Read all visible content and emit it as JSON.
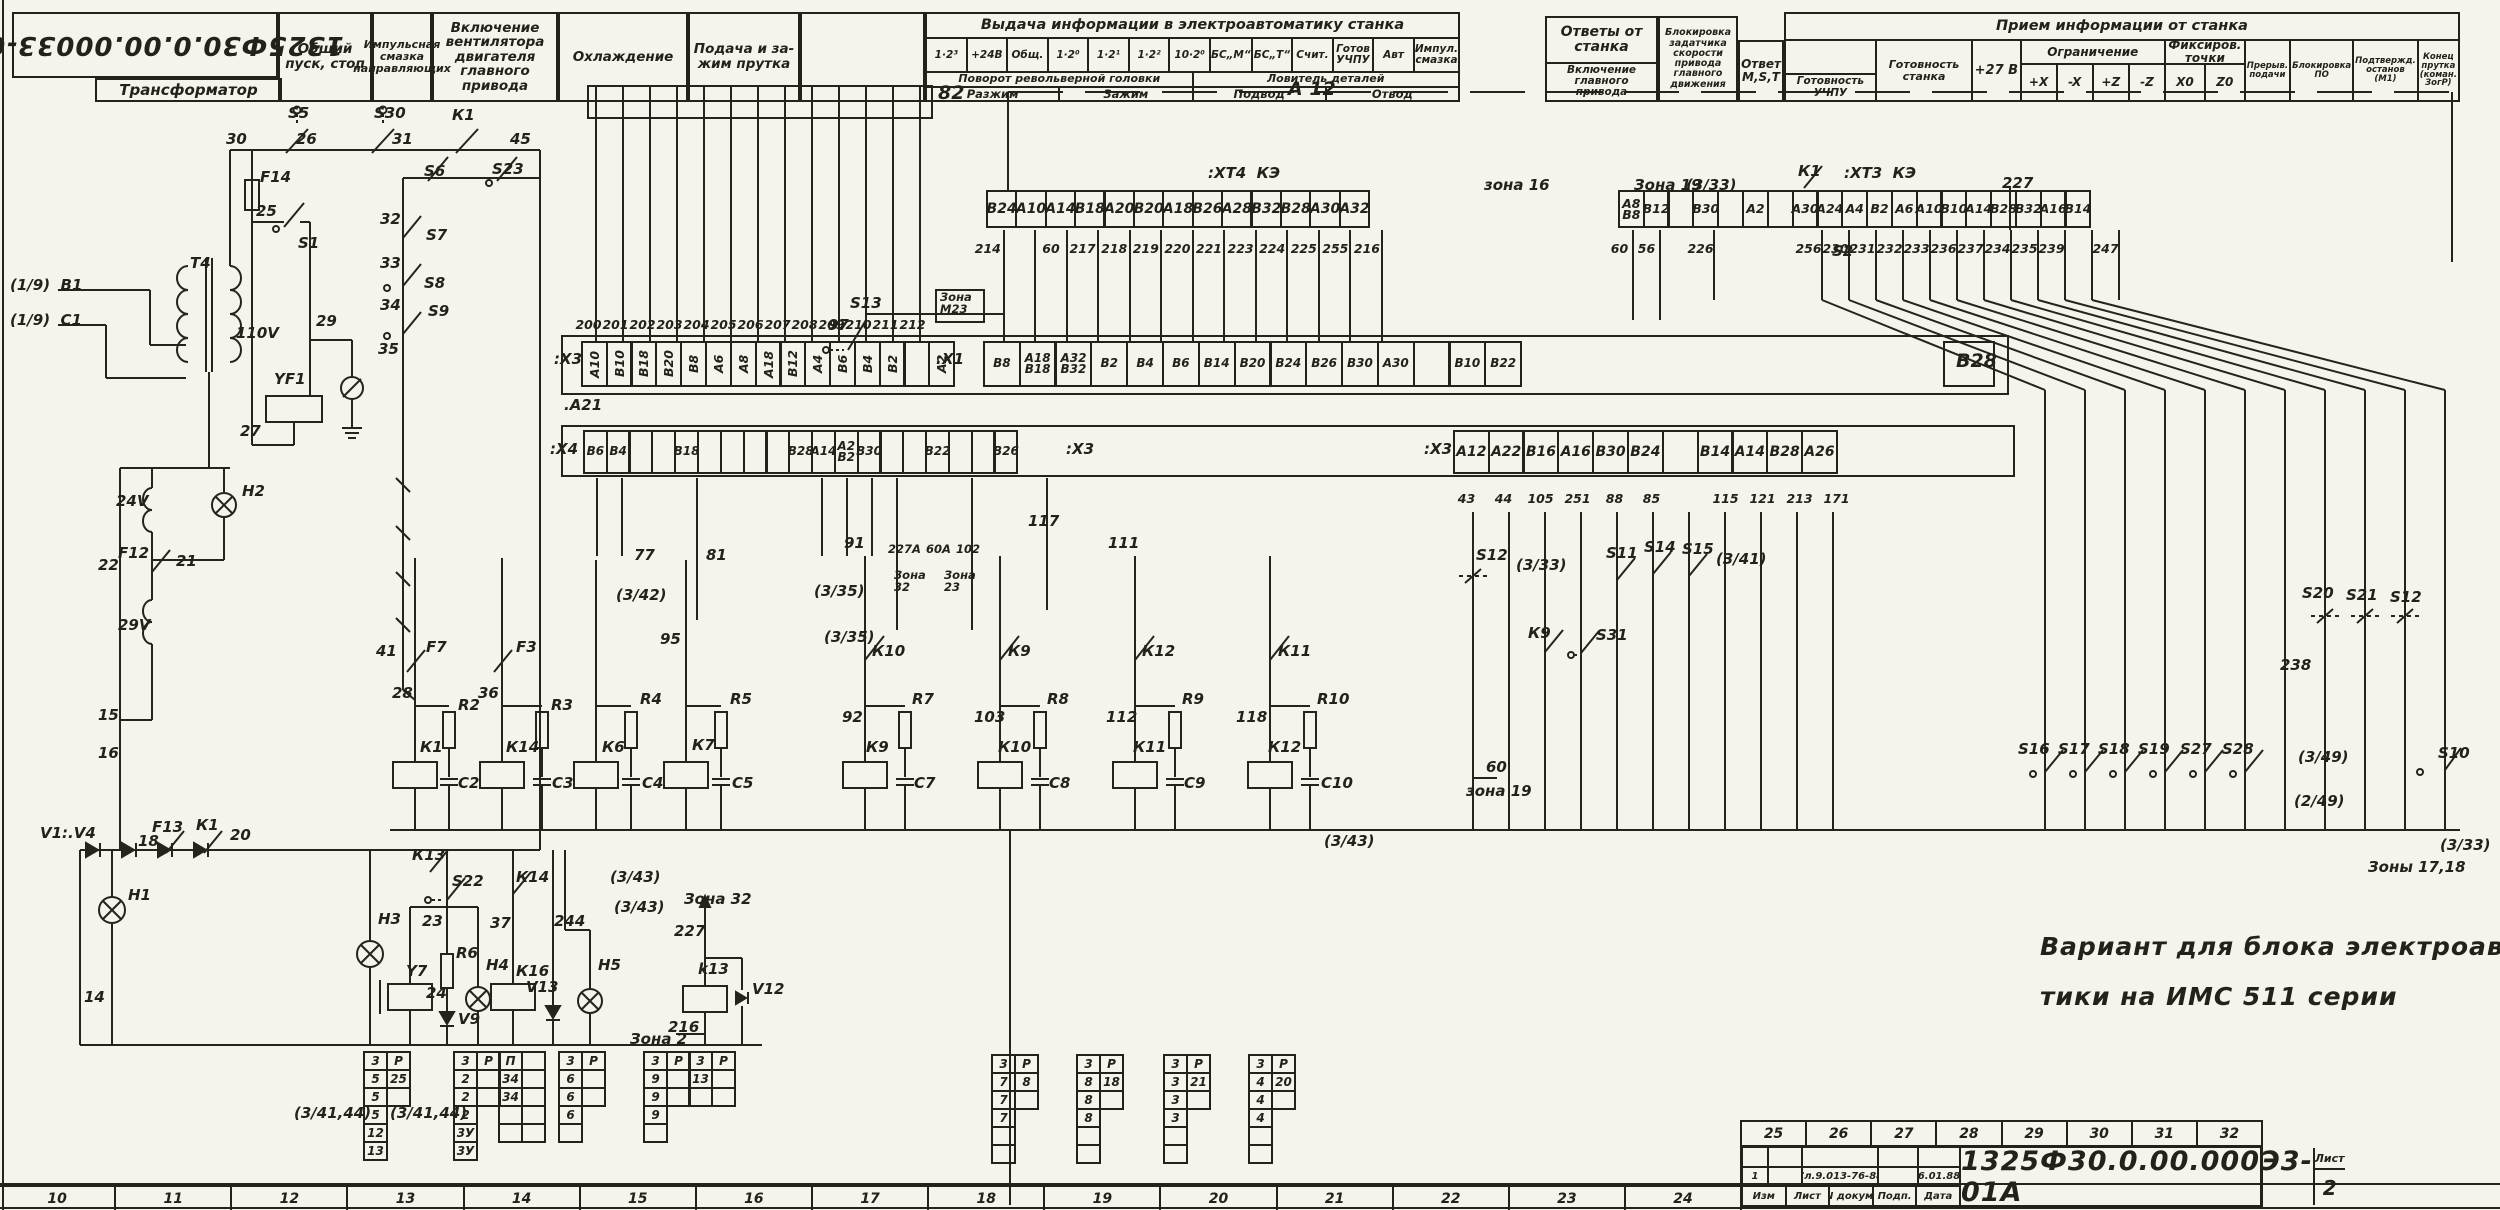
{
  "header": {
    "doc_number_mirrored": "1325Ф30.0.00.00033-01А",
    "transformer_label": "Трансформатор",
    "columns": [
      "Общий пуск, стоп",
      "Импульс­ная смазка направляющих",
      "Включение вентилятора двигателя главного привода",
      "Охлажде­ние",
      "Подача и за­жим прутка",
      ""
    ],
    "output_section": {
      "title": "Выдача информации в электроавтоматику станка",
      "signals": [
        "1·2³",
        "+24В",
        "Общ.",
        "1·2⁰",
        "1·2¹",
        "1·2²",
        "10·2⁰",
        "БС„М“",
        "БС„Т“",
        "Счит.",
        "Готов УЧПУ",
        "Авт",
        "Импул. смазка"
      ],
      "turret_title": "Поворот револьверной головки",
      "turret_cells": [
        "Разжим",
        "Зажим"
      ],
      "catcher_title": "Ловитель деталей",
      "catcher_cells": [
        "Подвод",
        "Отвод"
      ]
    },
    "answers_box": {
      "title": "Ответы от станка",
      "sub": "Включение главного привода"
    },
    "blocking_box": "Блокировка задатчика скорости привода главного движения",
    "answer_mst": "Ответ M,S,T",
    "input_section": {
      "title": "Прием информации от станка",
      "ready_cnc": "Готовность УЧПУ",
      "ready_machine": "Готовность станка",
      "plus27": "+27 В",
      "limit_title": "Ограничение",
      "limit_cells": [
        "+X",
        "-X",
        "+Z",
        "-Z"
      ],
      "fix_title": "Фиксиров. точки",
      "fix_cells": [
        "X0",
        "Z0"
      ],
      "tail_cells": [
        "Прерыв. подачи",
        "Блокировка ПО",
        "Подтвержд. останов (М1)",
        "Конец прутка (коман. ЗогР)"
      ]
    }
  },
  "strips": {
    "xt4": {
      "cells": [
        "В24",
        "А10",
        "А14",
        "В18",
        "А20",
        "В20",
        "А18",
        "В26",
        "А28",
        "В32",
        "В28",
        "А30",
        "А32"
      ],
      "wires": [
        "214",
        "",
        "60",
        "217",
        "218",
        "219",
        "220",
        "221",
        "223",
        "224",
        "225",
        "255",
        "216"
      ]
    },
    "xt3": {
      "cells": [
        "А8\nВ8",
        "В12",
        "",
        "В30",
        "",
        "А2",
        "",
        "А30",
        "А24",
        "А4",
        "В2",
        "А6",
        "А10",
        "В10",
        "А14",
        "В28",
        "В32",
        "А16",
        "В14"
      ],
      "wires": [
        "60",
        "56",
        "",
        "226",
        "",
        "",
        "",
        "256",
        "230",
        "231",
        "232",
        "233",
        "236",
        "237",
        "234",
        "235",
        "239",
        "",
        "247"
      ]
    },
    "x3l": {
      "cells": [
        "А10",
        "В10",
        "В18",
        "В20",
        "В8",
        "А6",
        "А8",
        "А18",
        "В12",
        "А4",
        "В6",
        "В4",
        "В2",
        "",
        "А2"
      ],
      "wires": [
        "200",
        "201",
        "202",
        "203",
        "204",
        "205",
        "206",
        "207",
        "208",
        "209",
        "210",
        "211",
        "212",
        "",
        ""
      ]
    },
    "x1": {
      "cells": [
        "В8",
        "А18\nВ18",
        "А32\nВ32",
        "В2",
        "В4",
        "В6",
        "В14",
        "В20",
        "В24",
        "В26",
        "В30",
        "А30",
        "",
        "В10",
        "В22"
      ],
      "extra": "В28"
    },
    "x4": {
      "cells": [
        "В6",
        "В4",
        "",
        "",
        "В18",
        "",
        "",
        "",
        "",
        "В28",
        "А14",
        "А2\nВ2",
        "В30",
        "",
        "",
        "В22",
        "",
        "",
        "В26"
      ]
    },
    "x3r": {
      "cells": [
        "А12",
        "А22",
        "В16",
        "А16",
        "В30",
        "В24",
        "",
        "В14",
        "А14",
        "В28",
        "А26"
      ],
      "wires": [
        "43",
        "44",
        "105",
        "251",
        "88",
        "85",
        "",
        "115",
        "121",
        "213",
        "171"
      ]
    }
  },
  "note": {
    "line1": "Вариант для блока электроавтома-",
    "line2": "тики на ИМС 511 серии"
  },
  "zones_bottom": [
    "10",
    "11",
    "12",
    "13",
    "14",
    "15",
    "16",
    "17",
    "18",
    "19",
    "20",
    "21",
    "22",
    "23",
    "24"
  ],
  "title_block": {
    "zones": [
      "25",
      "26",
      "27",
      "28",
      "29",
      "30",
      "31",
      "32"
    ],
    "doc_number": "1325Ф30.0.00.000Э3-01А",
    "sheet_label": "Лист",
    "sheet_number": "2",
    "rev_row": {
      "num": "1",
      "doc": "Сл.9.013-76-88",
      "sign": "",
      "date": "6.01.88"
    },
    "footer_cols": [
      "Изм",
      "Лист",
      "N докум.",
      "Подп.",
      "Дата"
    ]
  },
  "labels": [
    [
      "(1/9)  В1",
      10,
      278
    ],
    [
      "(1/9)  С1",
      10,
      313
    ],
    [
      "Т4",
      190,
      256
    ],
    [
      "110V",
      236,
      326
    ],
    [
      "30",
      226,
      132
    ],
    [
      "S5",
      288,
      106
    ],
    [
      "26",
      296,
      132
    ],
    [
      "S30",
      374,
      106
    ],
    [
      "31",
      392,
      132
    ],
    [
      "К1",
      452,
      108
    ],
    [
      "45",
      510,
      132
    ],
    [
      "F14",
      260,
      170
    ],
    [
      "25",
      256,
      204
    ],
    [
      "S1",
      298,
      236
    ],
    [
      "S6",
      424,
      164
    ],
    [
      "S23",
      492,
      162
    ],
    [
      "32",
      380,
      212
    ],
    [
      "S7",
      426,
      228
    ],
    [
      "33",
      380,
      256
    ],
    [
      "S8",
      424,
      276
    ],
    [
      "34",
      380,
      298
    ],
    [
      "S9",
      428,
      304
    ],
    [
      "35",
      378,
      342
    ],
    [
      "29",
      316,
      314
    ],
    [
      "YF1",
      274,
      372
    ],
    [
      "27",
      240,
      424
    ],
    [
      "24V",
      116,
      494
    ],
    [
      "Н2",
      242,
      484
    ],
    [
      "F12",
      118,
      546
    ],
    [
      "22",
      98,
      558
    ],
    [
      "21",
      176,
      554
    ],
    [
      "29V",
      118,
      618
    ],
    [
      "15",
      98,
      708
    ],
    [
      "16",
      98,
      746
    ],
    [
      "V1:.V4",
      40,
      826
    ],
    [
      "F13",
      152,
      820
    ],
    [
      "К1",
      196,
      818
    ],
    [
      "20",
      230,
      828
    ],
    [
      "18",
      138,
      834
    ],
    [
      "Н1",
      128,
      888
    ],
    [
      "14",
      84,
      990
    ],
    [
      "28",
      392,
      686
    ],
    [
      "41",
      376,
      644
    ],
    [
      "F7",
      426,
      640
    ],
    [
      "К1",
      420,
      740
    ],
    [
      "R2",
      458,
      698
    ],
    [
      "С2",
      458,
      776
    ],
    [
      "36",
      478,
      686
    ],
    [
      "F3",
      516,
      640
    ],
    [
      "К14",
      506,
      740
    ],
    [
      "R3",
      551,
      698
    ],
    [
      "С3",
      552,
      776
    ],
    [
      "К6",
      602,
      740
    ],
    [
      "R4",
      640,
      692
    ],
    [
      "С4",
      642,
      776
    ],
    [
      "95",
      660,
      632
    ],
    [
      "К7",
      692,
      738
    ],
    [
      "R5",
      730,
      692
    ],
    [
      "С5",
      732,
      776
    ],
    [
      "77",
      634,
      548
    ],
    [
      "81",
      706,
      548
    ],
    [
      "(3/42)",
      616,
      588
    ],
    [
      "(3/35)",
      814,
      584
    ],
    [
      "(3/35)",
      824,
      630
    ],
    [
      "82",
      938,
      84,
      "b"
    ],
    [
      ".А21",
      564,
      398
    ],
    [
      "А 12",
      1288,
      80,
      "b"
    ],
    [
      ":ХТ4  КЭ",
      1208,
      166
    ],
    [
      "S13",
      850,
      296
    ],
    [
      "97",
      828,
      318
    ],
    [
      "Зона\nМ23",
      940,
      292,
      "s"
    ],
    [
      "зона 16",
      1484,
      178
    ],
    [
      "Зона 19",
      1634,
      178
    ],
    [
      "(3/33)",
      1686,
      178
    ],
    [
      "К1",
      1798,
      164
    ],
    [
      "227",
      2002,
      176
    ],
    [
      "S2",
      1832,
      244
    ],
    [
      ":ХТ3  КЭ",
      1844,
      166
    ],
    [
      "91",
      844,
      536
    ],
    [
      "227А",
      888,
      544,
      "s"
    ],
    [
      "60А",
      926,
      544,
      "s"
    ],
    [
      "102",
      956,
      544,
      "s"
    ],
    [
      "Зона\n32",
      894,
      570,
      "s"
    ],
    [
      "Зона\n23",
      944,
      570,
      "s"
    ],
    [
      "К10",
      872,
      644
    ],
    [
      "92",
      842,
      710
    ],
    [
      "К9",
      866,
      740
    ],
    [
      "R7",
      912,
      692
    ],
    [
      "С7",
      914,
      776
    ],
    [
      "103",
      974,
      710
    ],
    [
      "К9",
      1008,
      644
    ],
    [
      "К10",
      998,
      740
    ],
    [
      "R8",
      1047,
      692
    ],
    [
      "С8",
      1049,
      776
    ],
    [
      "111",
      1108,
      536
    ],
    [
      "112",
      1106,
      710
    ],
    [
      "К12",
      1142,
      644
    ],
    [
      "К11",
      1133,
      740
    ],
    [
      "R9",
      1182,
      692
    ],
    [
      "С9",
      1184,
      776
    ],
    [
      "118",
      1236,
      710
    ],
    [
      "К11",
      1278,
      644
    ],
    [
      "К12",
      1268,
      740
    ],
    [
      "R10",
      1317,
      692
    ],
    [
      "С10",
      1321,
      776
    ],
    [
      "117",
      1028,
      514
    ],
    [
      "(3/43)",
      1324,
      834
    ],
    [
      "S12",
      1476,
      548
    ],
    [
      "(3/33)",
      1516,
      558
    ],
    [
      "К9",
      1528,
      626
    ],
    [
      "S31",
      1596,
      628
    ],
    [
      "S11",
      1606,
      546
    ],
    [
      "S14",
      1644,
      540
    ],
    [
      "S15",
      1682,
      542
    ],
    [
      "(3/41)",
      1716,
      552
    ],
    [
      "60",
      1486,
      760
    ],
    [
      "зона 19",
      1466,
      784
    ],
    [
      "S20",
      2302,
      586
    ],
    [
      "S21",
      2346,
      588
    ],
    [
      "S12",
      2390,
      590
    ],
    [
      "238",
      2280,
      658
    ],
    [
      "S16",
      2018,
      742
    ],
    [
      "S17",
      2058,
      742
    ],
    [
      "S18",
      2098,
      742
    ],
    [
      "S19",
      2138,
      742
    ],
    [
      "S27",
      2180,
      742
    ],
    [
      "S28",
      2222,
      742
    ],
    [
      "(3/49)",
      2298,
      750
    ],
    [
      "(2/49)",
      2294,
      794
    ],
    [
      "S10",
      2438,
      746
    ],
    [
      "(3/33)",
      2440,
      838
    ],
    [
      "Зоны 17,18",
      2368,
      860
    ],
    [
      "Н3",
      378,
      912
    ],
    [
      "К13",
      412,
      848
    ],
    [
      "S22",
      452,
      874
    ],
    [
      "23",
      422,
      914
    ],
    [
      "Y7",
      406,
      964
    ],
    [
      "R6",
      456,
      946
    ],
    [
      "24",
      426,
      986
    ],
    [
      "V9",
      458,
      1012
    ],
    [
      "Н4",
      486,
      958
    ],
    [
      "К16",
      516,
      964
    ],
    [
      "К14",
      516,
      870
    ],
    [
      "37",
      490,
      916
    ],
    [
      "244",
      554,
      914
    ],
    [
      "V13",
      526,
      980
    ],
    [
      "Н5",
      598,
      958
    ],
    [
      "(3/43)",
      610,
      870
    ],
    [
      "(3/43)",
      614,
      900
    ],
    [
      "Зона 32",
      684,
      892
    ],
    [
      "227",
      674,
      924
    ],
    [
      "k13",
      698,
      962
    ],
    [
      "V12",
      752,
      982
    ],
    [
      "216",
      668,
      1020
    ],
    [
      "Зона 2",
      630,
      1032
    ],
    [
      "(3/41,44)",
      294,
      1106
    ],
    [
      "(3/41,44)",
      390,
      1106
    ],
    [
      ":Х3",
      554,
      352
    ],
    [
      ":Х1",
      936,
      352
    ],
    [
      ":Х4",
      550,
      442
    ],
    [
      ":Х3",
      1066,
      442
    ],
    [
      ":Х3",
      1424,
      442
    ],
    [
      "В28",
      1956,
      352,
      "b"
    ]
  ],
  "tables": [
    {
      "x": 365,
      "y": 1053,
      "rows": [
        [
          "3",
          "Р"
        ],
        [
          "5",
          "25"
        ],
        [
          "5",
          ""
        ],
        [
          "5"
        ],
        [
          "12"
        ],
        [
          "13"
        ]
      ]
    },
    {
      "x": 455,
      "y": 1053,
      "rows": [
        [
          "3",
          "Р"
        ],
        [
          "2",
          ""
        ],
        [
          "2",
          ""
        ],
        [
          "2"
        ],
        [
          "3У"
        ],
        [
          "3У"
        ]
      ]
    },
    {
      "x": 500,
      "y": 1053,
      "rows": [
        [
          "П",
          ""
        ],
        [
          "34",
          ""
        ],
        [
          "34",
          ""
        ],
        [
          "",
          ""
        ],
        [
          "",
          ""
        ]
      ]
    },
    {
      "x": 560,
      "y": 1053,
      "rows": [
        [
          "3",
          "Р"
        ],
        [
          "6",
          ""
        ],
        [
          "6",
          ""
        ],
        [
          "6"
        ],
        [
          ""
        ]
      ]
    },
    {
      "x": 645,
      "y": 1053,
      "rows": [
        [
          "3",
          "Р"
        ],
        [
          "9",
          ""
        ],
        [
          "9",
          ""
        ],
        [
          "9"
        ],
        [
          ""
        ]
      ]
    },
    {
      "x": 690,
      "y": 1053,
      "rows": [
        [
          "3",
          "Р"
        ],
        [
          "13",
          ""
        ],
        [
          "",
          ""
        ]
      ]
    },
    {
      "x": 993,
      "y": 1056,
      "rows": [
        [
          "3",
          "Р"
        ],
        [
          "7",
          "8"
        ],
        [
          "7",
          ""
        ],
        [
          "7"
        ],
        [
          ""
        ],
        [
          ""
        ]
      ]
    },
    {
      "x": 1078,
      "y": 1056,
      "rows": [
        [
          "3",
          "Р"
        ],
        [
          "8",
          "18"
        ],
        [
          "8",
          ""
        ],
        [
          "8"
        ],
        [
          ""
        ],
        [
          ""
        ]
      ]
    },
    {
      "x": 1165,
      "y": 1056,
      "rows": [
        [
          "3",
          "Р"
        ],
        [
          "3",
          "21"
        ],
        [
          "3",
          ""
        ],
        [
          "3"
        ],
        [
          ""
        ],
        [
          ""
        ]
      ]
    },
    {
      "x": 1250,
      "y": 1056,
      "rows": [
        [
          "3",
          "Р"
        ],
        [
          "4",
          "20"
        ],
        [
          "4",
          ""
        ],
        [
          "4"
        ],
        [
          ""
        ],
        [
          ""
        ]
      ]
    }
  ]
}
